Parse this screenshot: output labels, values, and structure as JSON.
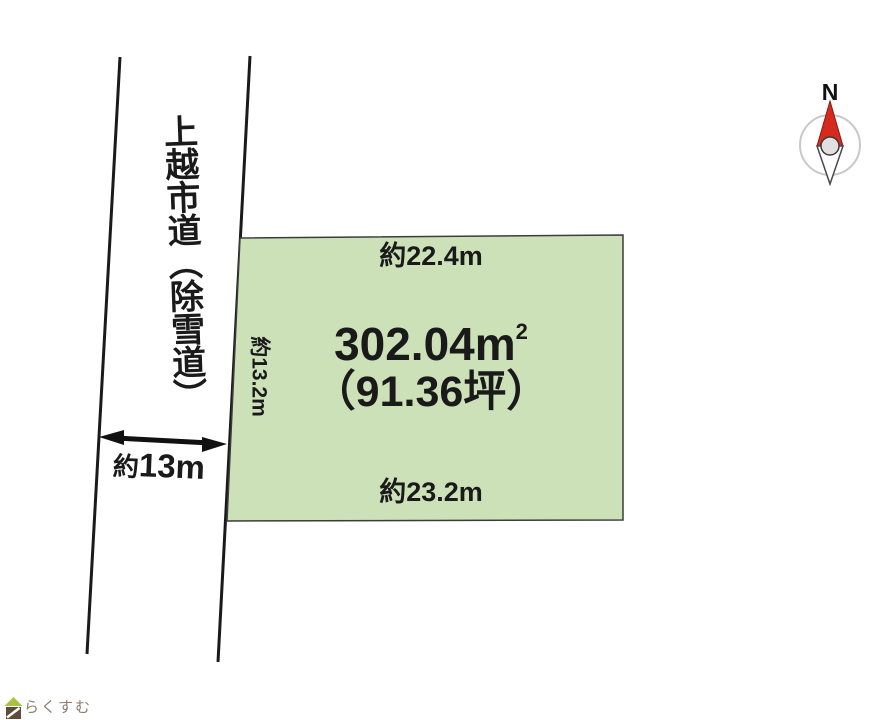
{
  "road": {
    "name_label": "上越市道（除雪道）",
    "width_about": "約",
    "width_value": "13m"
  },
  "plot": {
    "top_edge_label": "約22.4m",
    "bottom_edge_label": "約23.2m",
    "left_edge_label": "約13.2m",
    "area_sqm_value": "302.04",
    "area_sqm_unit": "m",
    "area_sqm_exponent": "2",
    "area_tsubo_label": "（91.36坪）",
    "fill_color": "#cde1b9",
    "border_color": "#3c3c3c"
  },
  "compass": {
    "north_label": "N",
    "needle_color": "#d42b1e"
  },
  "branding": {
    "logo_text": "らくすむ",
    "logo_text_color": "#8d7b6e",
    "logo_roof_color": "#a9c23f",
    "logo_body_color": "#5d4b3c"
  }
}
